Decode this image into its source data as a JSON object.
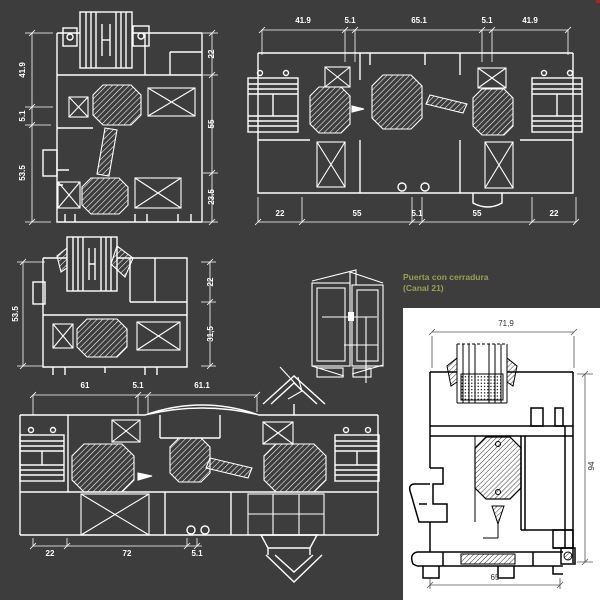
{
  "colors": {
    "background": "#3d3d3d",
    "line": "#ffffff",
    "panel_background": "#ffffff",
    "panel_line": "#000000",
    "note_text": "#9aa04f",
    "panel_dim_text": "#333333",
    "corner_mark": "#b22222"
  },
  "note": {
    "line1": "Puerta con cerradura",
    "line2": "(Canal 21)"
  },
  "section_top_left": {
    "dims_left": [
      "41.9",
      "5.1",
      "53.5"
    ],
    "dims_right": [
      "22",
      "55",
      "23.5"
    ]
  },
  "section_top_right": {
    "dims_top": [
      "41.9",
      "5.1",
      "65.1",
      "5.1",
      "41.9"
    ],
    "dims_bottom": [
      "22",
      "55",
      "5.1",
      "55",
      "22"
    ]
  },
  "section_middle_left": {
    "dim_left": "53.5",
    "dims_right": [
      "22",
      "31,5"
    ]
  },
  "section_bottom_left": {
    "dims_top": [
      "61",
      "5.1",
      "61.1"
    ],
    "dims_bottom": [
      "22",
      "72",
      "5.1"
    ]
  },
  "detail_panel": {
    "dim_top": "71,9",
    "dim_right": "94",
    "dim_bottom": "65"
  }
}
